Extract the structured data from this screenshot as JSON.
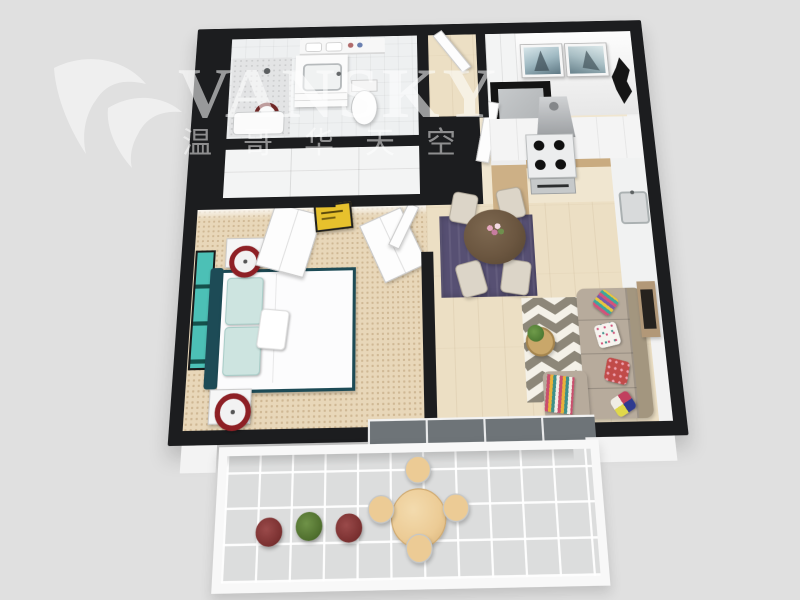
{
  "scene": {
    "description": "3D rendered top-down floor plan of a one-bedroom apartment with balcony",
    "background_color": "#e0e0e0",
    "wall_color": "#1c1d1f"
  },
  "watermark": {
    "brand": "VANSKY",
    "brand_cjk": "温哥华天空",
    "logo": "swan",
    "text_color": "#ffffff"
  },
  "rooms": {
    "bathroom": {
      "fixtures": [
        "shower",
        "vanity sink",
        "toilet",
        "laundry shelf"
      ]
    },
    "bedroom": {
      "bed": "double bed, white duvet, dark teal frame",
      "bed_frame_color": "#1d4b56",
      "pillow_color": "#cde4e0",
      "carpet_color": "#e8d7b9",
      "wall_art": "teal triptych",
      "nightstands": 2,
      "lamp_ring_color": "#8e2025",
      "sign_color": "#e7c12d"
    },
    "kitchen": {
      "layout": "U-shaped",
      "burners": 4,
      "cabinet_color": "#cdb086",
      "appliances": [
        "range hood",
        "stove",
        "oven",
        "sink"
      ],
      "wall_art": [
        "two sailboat pictures",
        "black diamond sculpture"
      ]
    },
    "dining": {
      "rug_color": "#575073",
      "table": "round dark wood",
      "table_color": "#6b5640",
      "chairs": 4,
      "chair_color": "#dcd5c8",
      "centerpiece": "pink flowers"
    },
    "living": {
      "sofa_color": "#b7ab9c",
      "rug_pattern": "chevron",
      "rug_colors": [
        "#8d8779",
        "#f4f1e8"
      ],
      "throw_pillows": 4,
      "tv": "wall-mounted on wood panel"
    },
    "balcony": {
      "floor": "light tile",
      "table_color": "#eccb95",
      "stools": 4,
      "plants": 3,
      "plant_colors": [
        "#7b3131",
        "#50702e",
        "#7b3131"
      ]
    }
  }
}
